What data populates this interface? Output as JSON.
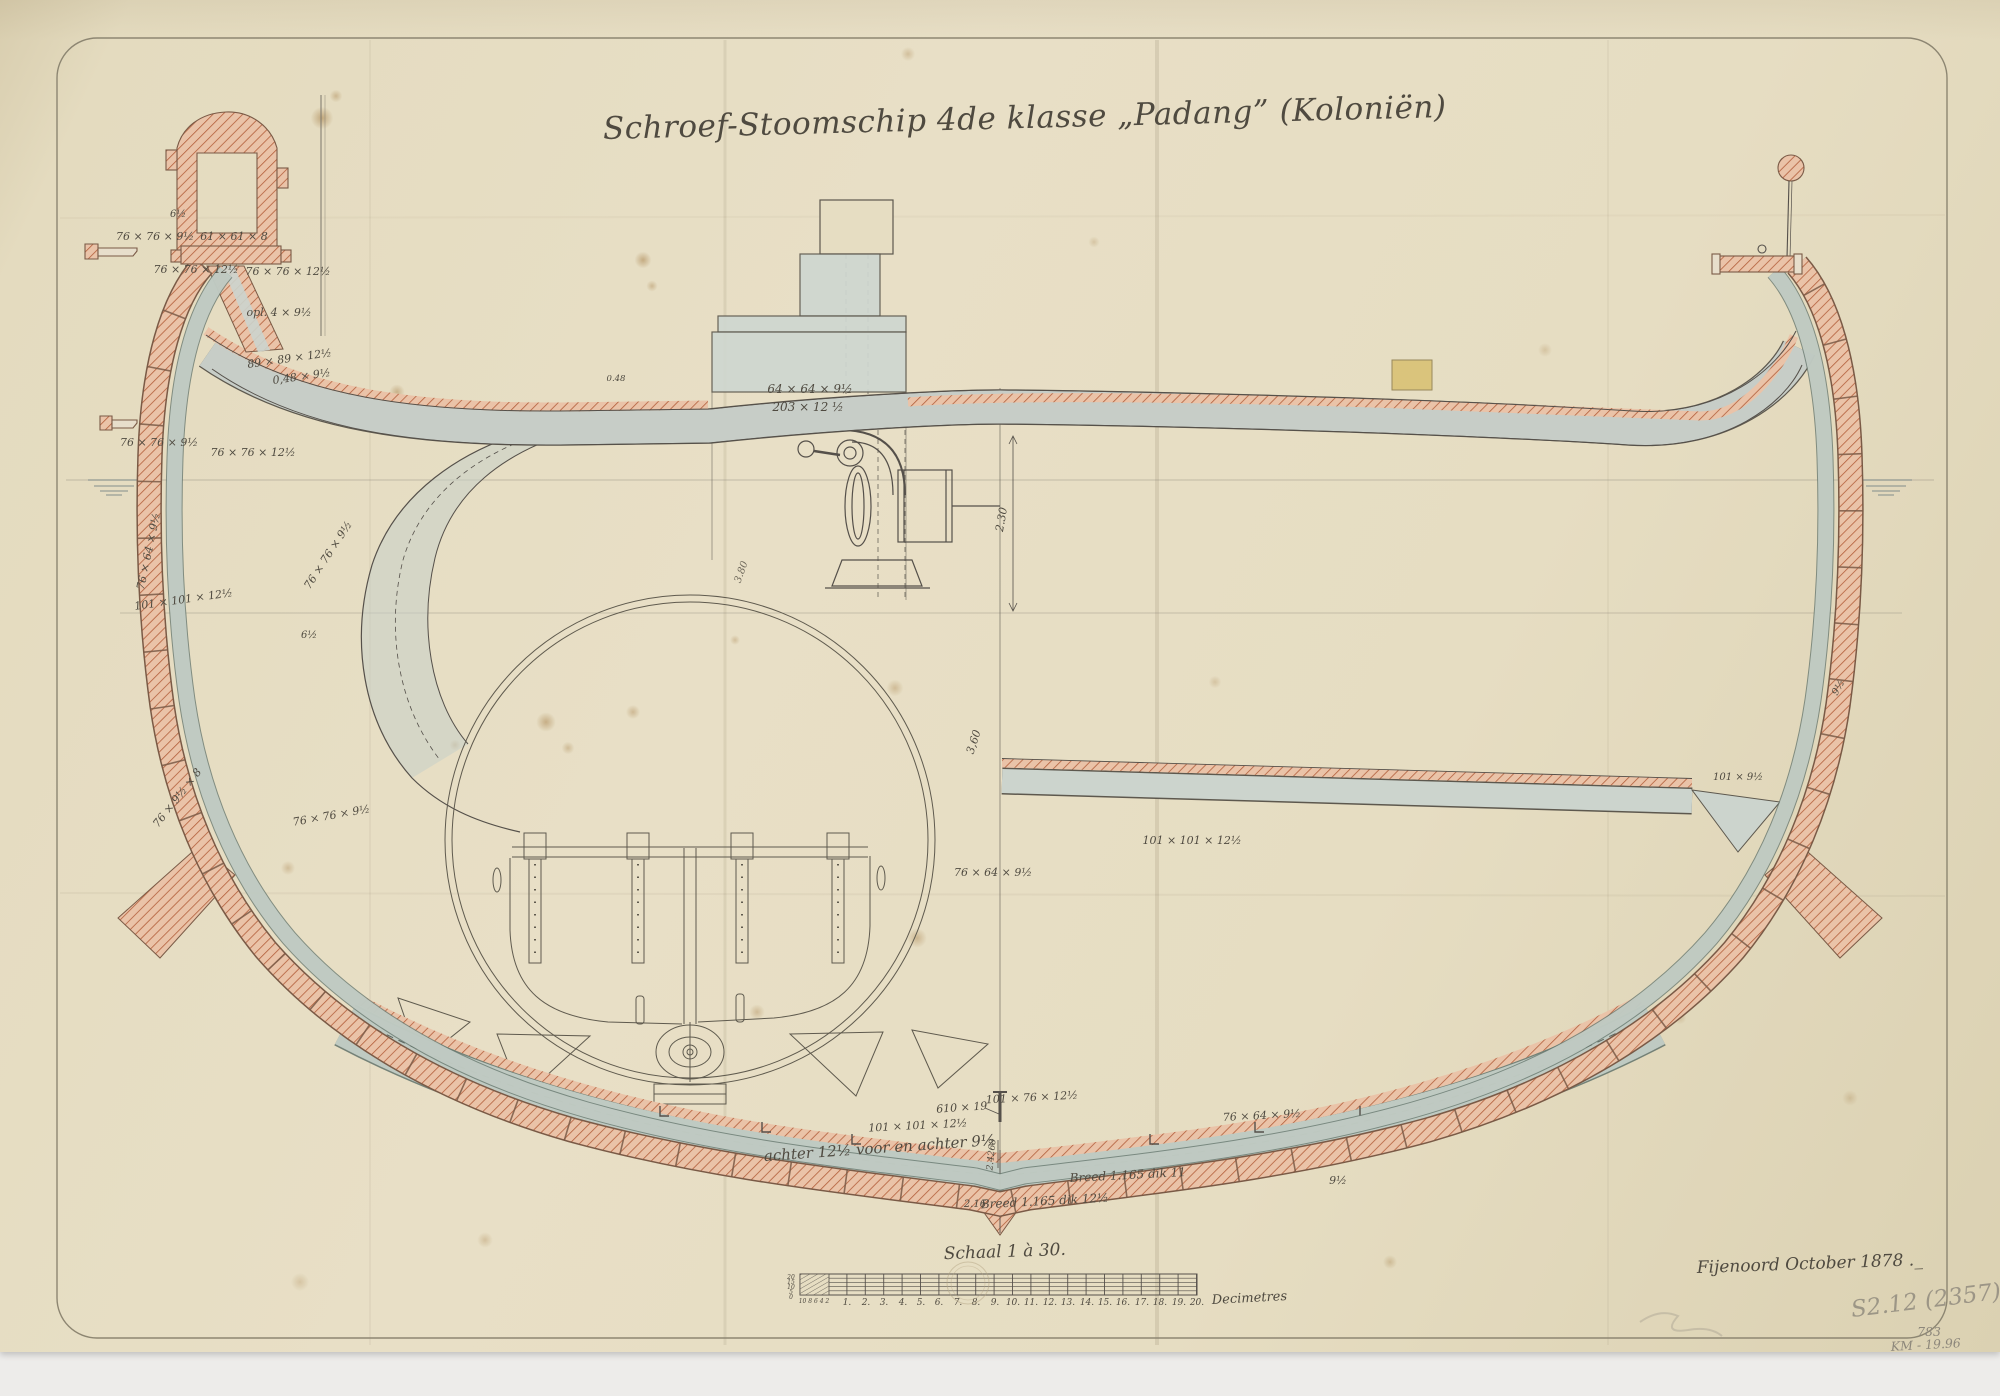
{
  "document": {
    "title": "Schroef-Stoomschip 4de klasse „Padang” (Koloniën)",
    "scale_caption": "Schaal 1 à 30.",
    "signature": "Fijenoord October 1878 ._",
    "stamp_number": "S2.12 (2357)",
    "pencil_note_top": "783",
    "pencil_note_bottom": "KM - 19.96"
  },
  "scale_bar": {
    "unit_label": "Decimetres",
    "numbers": [
      "1.",
      "2.",
      "3.",
      "4.",
      "5.",
      "6.",
      "7.",
      "8.",
      "9.",
      "10.",
      "11.",
      "12.",
      "13.",
      "14.",
      "15.",
      "16.",
      "17.",
      "18.",
      "19.",
      "20."
    ],
    "left_ticks": [
      "20",
      "15",
      "10",
      "5",
      "0"
    ],
    "sub_ticks": "10 8 6 4 2"
  },
  "annotations": {
    "rail_detail": [
      "6½",
      "76 × 76 × 9½",
      "61 × 61 × 8",
      "76 × 76 × 12½",
      "76 × 76 × 12½",
      "opl. 4 × 9½"
    ],
    "deck_edge_left": [
      "89 × 89 × 12½",
      "0,48 × 9½",
      "76 × 76 × 9½",
      "76 × 76 × 12½"
    ],
    "side_frame_left": [
      "76 × 64 × 9½",
      "101 × 101 × 12½",
      "76 × 9½ × 8"
    ],
    "bunker_wall": [
      "76 × 76 × 9½",
      "6½",
      "76 × 76 × 9½"
    ],
    "deck_center": [
      "0.48",
      "64 × 64 × 9½",
      "203 × 12 ½"
    ],
    "dimensions": [
      "2.30",
      "3,60",
      "3.80",
      "2.4268",
      "2.16"
    ],
    "hold_right": [
      "76 × 64 × 9½",
      "101 × 101 × 12½",
      "101 × 9½",
      "9½"
    ],
    "bottom_shell": [
      "610 × 19",
      "101 × 76 × 12½",
      "101 × 101 × 12½",
      "achter 12½ voor en achter 9½",
      "Breed 1.165 dik 12½",
      "Breed 1.165 dik 11",
      "9½",
      "76 × 64 × 9½"
    ]
  },
  "colors": {
    "paper": "#e6ddc2",
    "ink": "#55504a",
    "iron_hatch": "#b35f3b",
    "iron_fill": "#eac3a8",
    "plating": "#c6d0c9"
  }
}
